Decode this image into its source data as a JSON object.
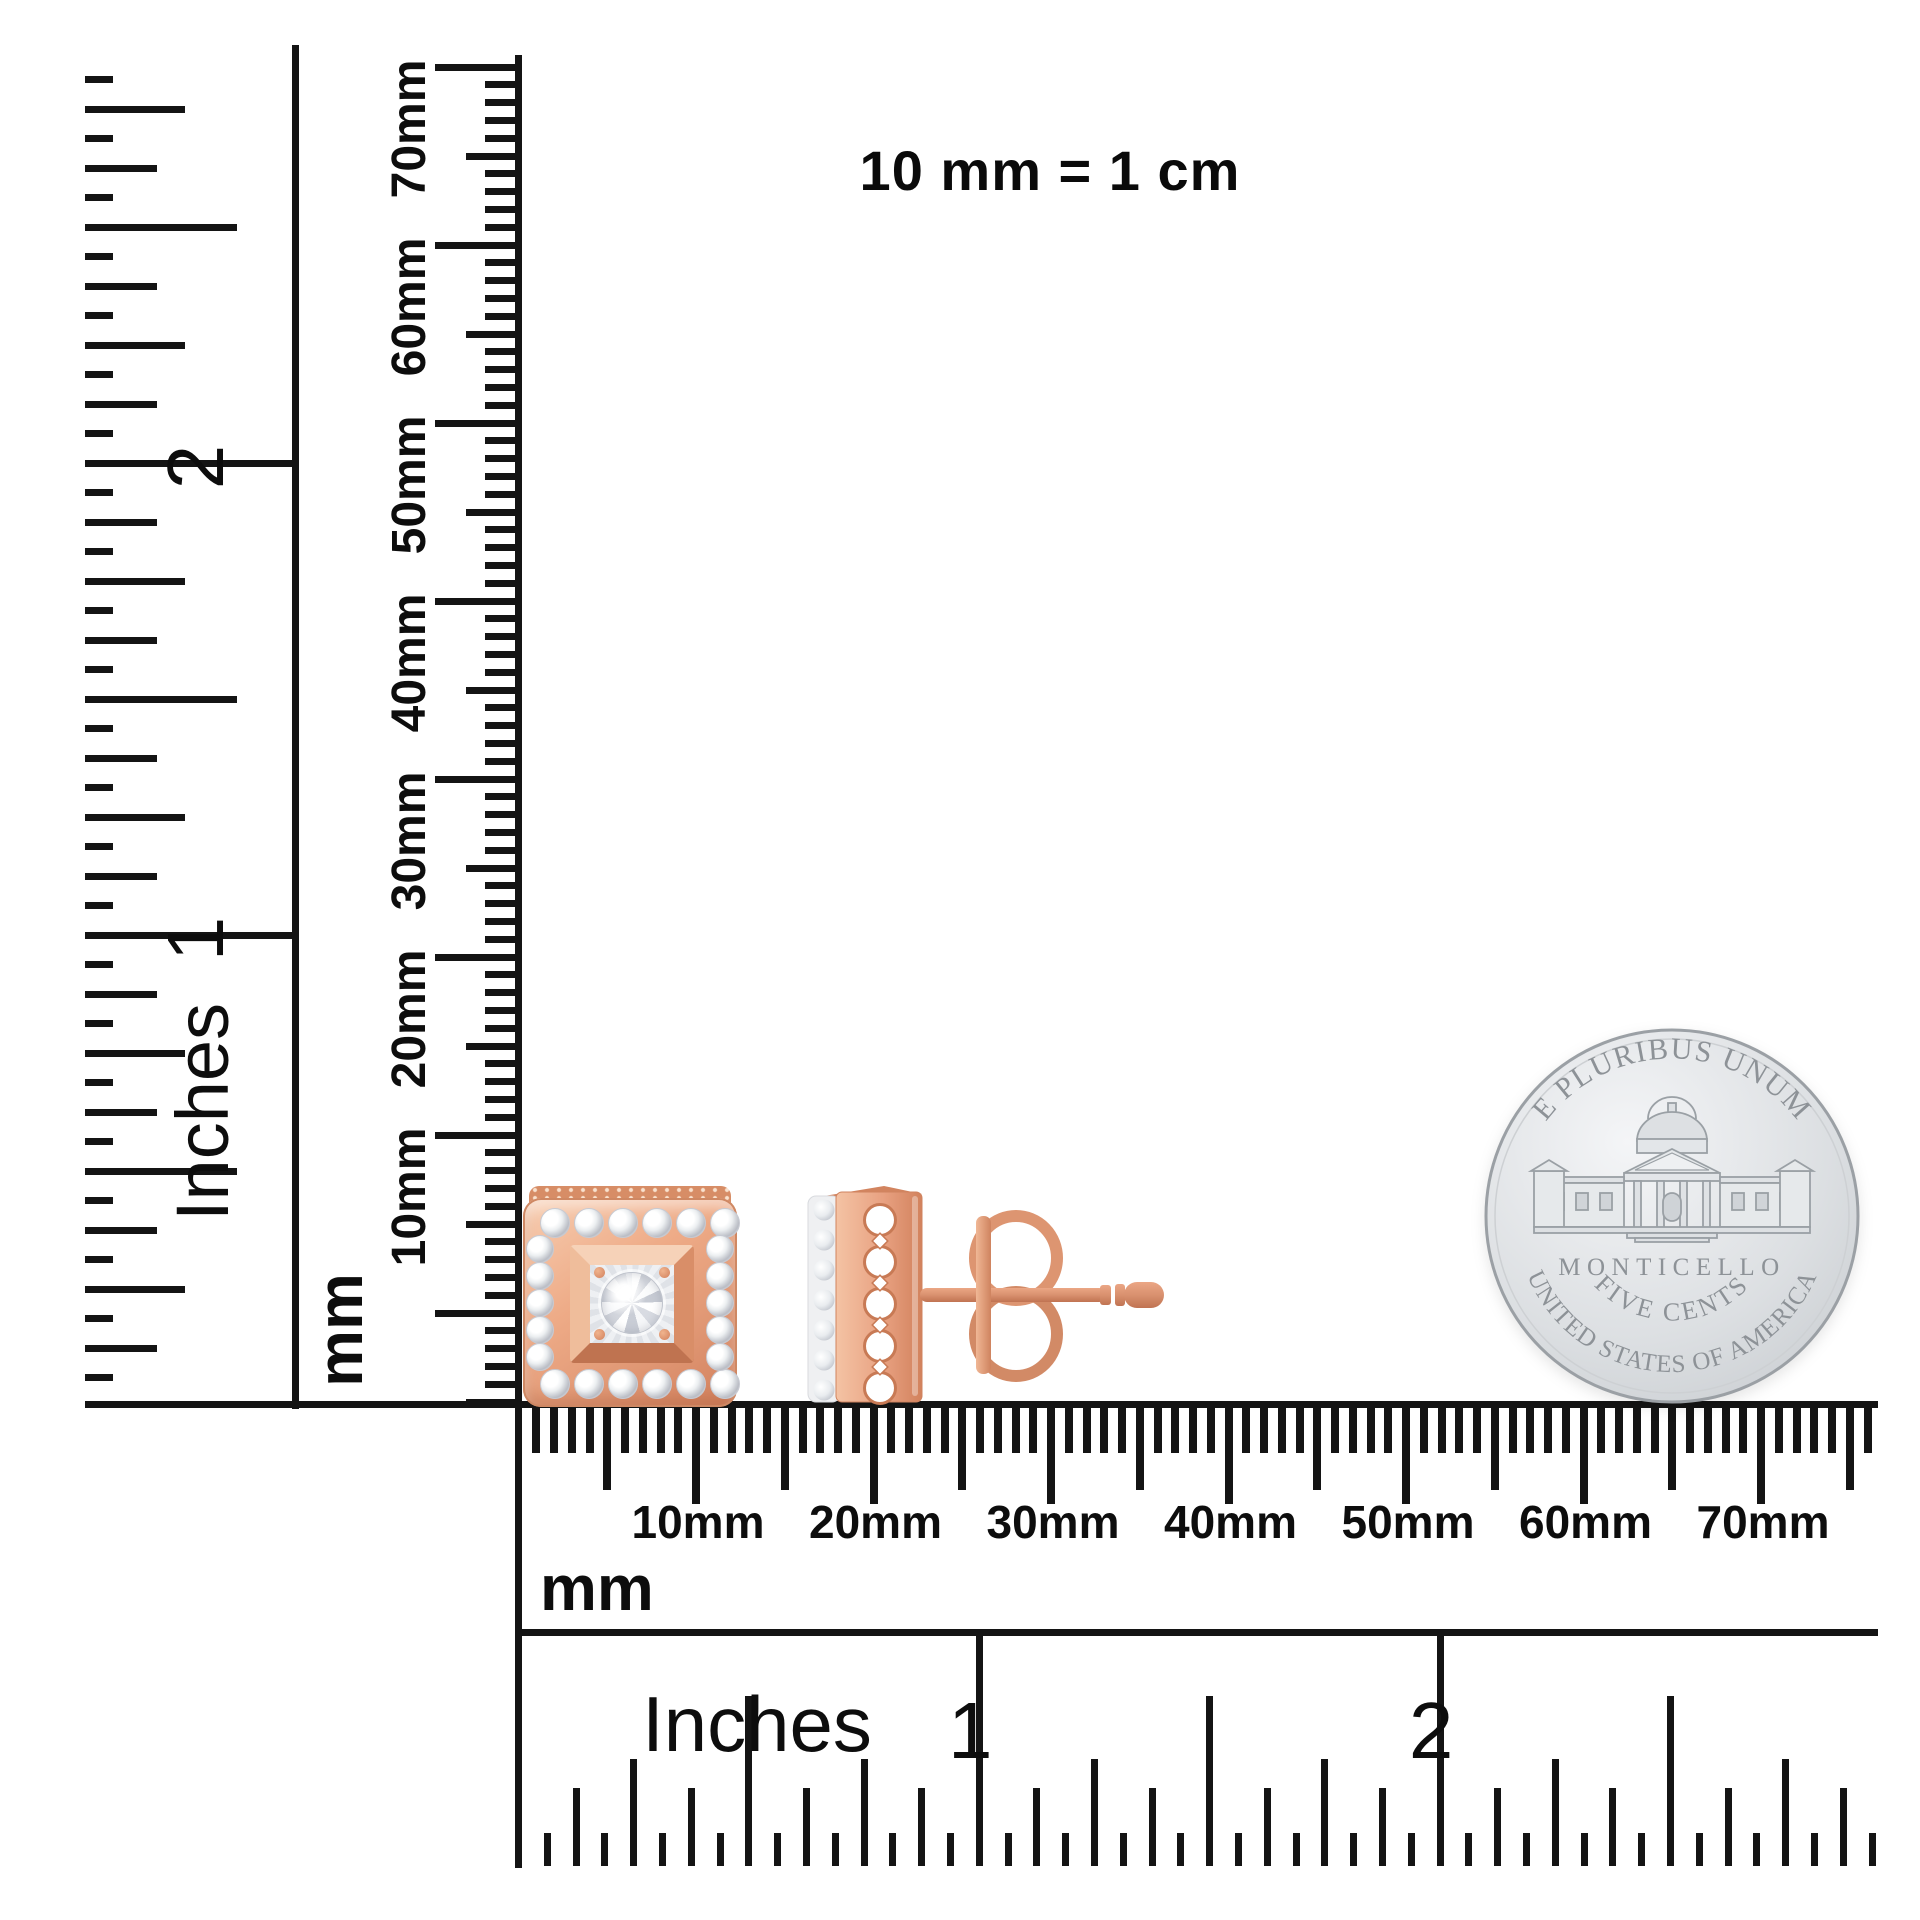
{
  "title": "10 mm = 1 cm",
  "rulers": {
    "left_inch": {
      "unit": "Inches",
      "numbers": [
        "1",
        "2"
      ]
    },
    "vertical_mm": {
      "unit": "mm",
      "labels": [
        "10mm",
        "20mm",
        "30mm",
        "40mm",
        "50mm",
        "60mm",
        "70mm"
      ]
    },
    "bottom_mm": {
      "unit": "mm",
      "labels": [
        "10mm",
        "20mm",
        "30mm",
        "40mm",
        "50mm",
        "60mm",
        "70mm"
      ]
    },
    "bottom_inch": {
      "unit": "Inches",
      "numbers": [
        "1",
        "2"
      ]
    }
  },
  "coin": {
    "legend_top": "E PLURIBUS UNUM",
    "building": "MONTICELLO",
    "denomination": "FIVE CENTS",
    "legend_bottom": "UNITED STATES OF AMERICA"
  },
  "colors": {
    "ink": "#141414",
    "rose_gold_light": "#f7ceb2",
    "rose_gold": "#e8a181",
    "rose_gold_deep": "#c87a55",
    "diamond_white": "#f4f5f7",
    "coin_silver": "#dcdfe2",
    "coin_engraving": "#8d9297"
  }
}
